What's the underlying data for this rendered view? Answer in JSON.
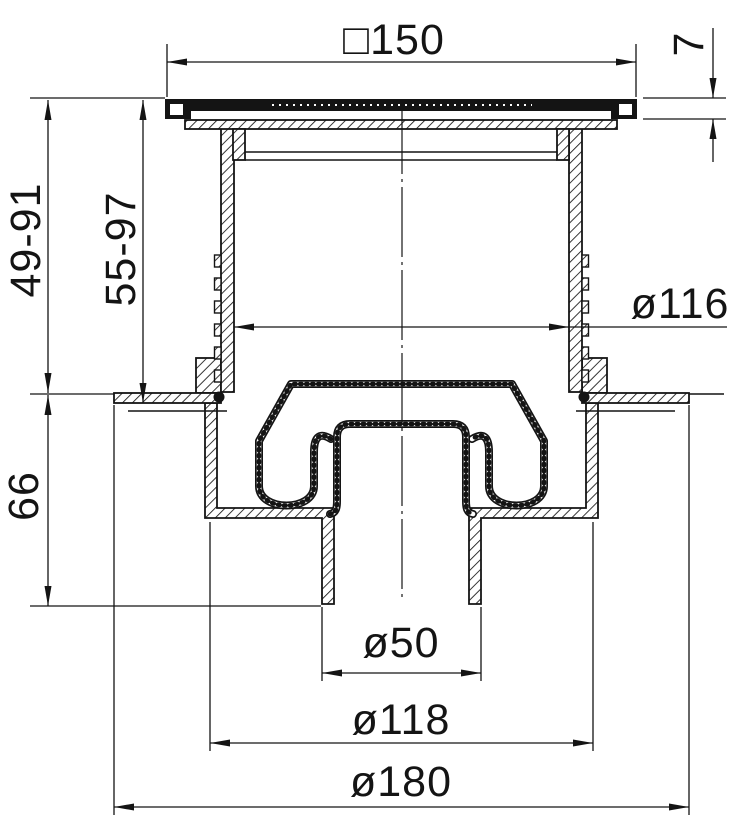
{
  "drawing": {
    "type": "floor-drain-cross-section",
    "background": "#ffffff",
    "line_color": "#141414",
    "dimensions": {
      "top_width": {
        "label": "□150",
        "meaning": "square grate frame width"
      },
      "grate_thickness": {
        "label": "7",
        "meaning": "grate frame height"
      },
      "depth_range_outer": {
        "label": "49-91",
        "meaning": "adjustable installation depth"
      },
      "depth_range_inner": {
        "label": "55-97",
        "meaning": "adjustable installation depth"
      },
      "body_height": {
        "label": "66",
        "meaning": "body height below floor"
      },
      "thread_diameter": {
        "label": "ø116",
        "meaning": "extension tube inner/thread diameter"
      },
      "outlet_diameter": {
        "label": "ø50",
        "meaning": "outlet pipe diameter"
      },
      "bowl_diameter": {
        "label": "ø118",
        "meaning": "body bowl diameter"
      },
      "flange_diameter": {
        "label": "ø180",
        "meaning": "body flange diameter"
      }
    }
  }
}
